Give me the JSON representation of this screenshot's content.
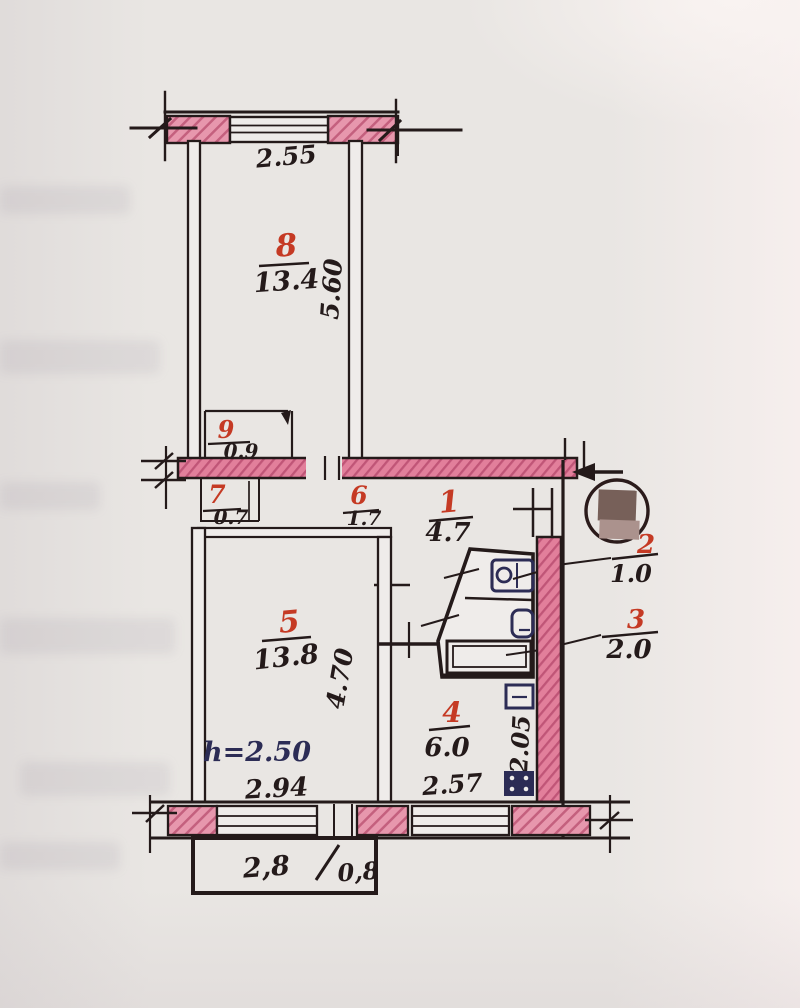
{
  "document": {
    "kind_label": "floor-plan-scan"
  },
  "colors": {
    "paper": "#e9e6e3",
    "ink": "#241a1a",
    "wall_pink": "#e797ad",
    "wall_pink_dark": "#c4607e",
    "room_number_red": "#c53a24",
    "annotation_navy": "#2c2c55",
    "censor_dark": "#776059",
    "censor_light": "#ab928d"
  },
  "plan": {
    "rooms": [
      {
        "number": "8",
        "area": "13.4"
      },
      {
        "number": "9",
        "area": "0.9"
      },
      {
        "number": "7",
        "area": "0.7"
      },
      {
        "number": "6",
        "area": "1.7"
      },
      {
        "number": "1",
        "area": "4.7"
      },
      {
        "number": "2",
        "area": "1.0"
      },
      {
        "number": "3",
        "area": "2.0"
      },
      {
        "number": "5",
        "area": "13.8"
      },
      {
        "number": "4",
        "area": "6.0"
      }
    ],
    "dimensions": {
      "top_window": "2.55",
      "room8_depth": "5.60",
      "room5_width": "2.94",
      "room5_depth": "4.70",
      "ceiling_height": "h=2.50",
      "kitchen_width": "2.57",
      "kitchen_depth": "2.05",
      "balcony_left": "2,8",
      "balcony_right": "0,8"
    }
  }
}
